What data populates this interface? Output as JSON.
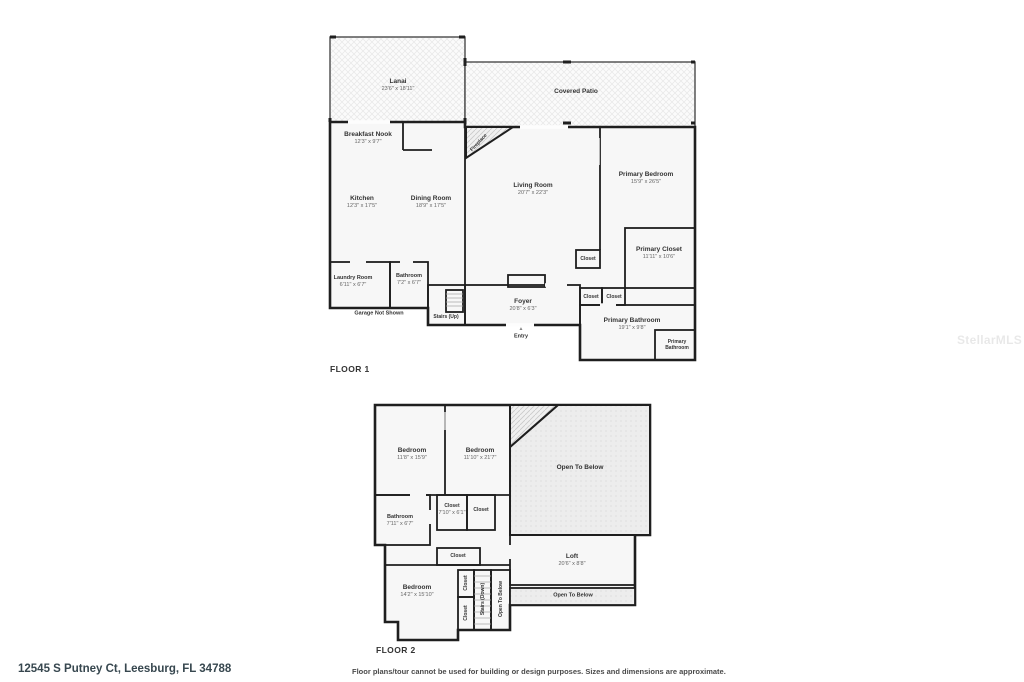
{
  "floor1": {
    "title": "FLOOR 1",
    "rooms": {
      "lanai": {
        "name": "Lanai",
        "dims": "23'6\" x 18'11\""
      },
      "covered_patio": {
        "name": "Covered Patio"
      },
      "breakfast_nook": {
        "name": "Breakfast Nook",
        "dims": "12'3\" x 9'7\""
      },
      "fireplace": {
        "name": "Fireplace"
      },
      "kitchen": {
        "name": "Kitchen",
        "dims": "12'3\" x 17'5\""
      },
      "dining_room": {
        "name": "Dining Room",
        "dims": "18'9\" x 17'5\""
      },
      "living_room": {
        "name": "Living Room",
        "dims": "20'7\" x 22'3\""
      },
      "primary_bedroom": {
        "name": "Primary Bedroom",
        "dims": "15'9\" x 26'5\""
      },
      "primary_closet": {
        "name": "Primary Closet",
        "dims": "11'11\" x 10'6\""
      },
      "laundry_room": {
        "name": "Laundry Room",
        "dims": "6'11\" x 6'7\""
      },
      "bathroom": {
        "name": "Bathroom",
        "dims": "7'2\" x 6'7\""
      },
      "foyer": {
        "name": "Foyer",
        "dims": "20'8\" x 6'3\""
      },
      "primary_bathroom": {
        "name": "Primary Bathroom",
        "dims": "19'1\" x 9'8\""
      },
      "primary_bathroom_small": {
        "name": "Primary Bathroom"
      },
      "closet": {
        "name": "Closet"
      }
    },
    "notes": {
      "stairs_up": "Stairs (Up)",
      "garage": "Garage Not Shown",
      "entry": "Entry",
      "entry_marker": "▲"
    }
  },
  "floor2": {
    "title": "FLOOR 2",
    "rooms": {
      "bedroom_left": {
        "name": "Bedroom",
        "dims": "11'8\" x 15'9\""
      },
      "bedroom_mid": {
        "name": "Bedroom",
        "dims": "11'10\" x 21'7\""
      },
      "open_to_below": {
        "name": "Open To Below"
      },
      "bathroom": {
        "name": "Bathroom",
        "dims": "7'11\" x 6'7\""
      },
      "closet_with_dims": {
        "name": "Closet",
        "dims": "7'10\" x 6'1\""
      },
      "closet": {
        "name": "Closet"
      },
      "loft": {
        "name": "Loft",
        "dims": "20'6\" x 8'8\""
      },
      "bedroom_bottom": {
        "name": "Bedroom",
        "dims": "14'2\" x 15'10\""
      },
      "stairs_down": {
        "name": "Stairs (Down)"
      }
    }
  },
  "footer": {
    "address": "12545 S Putney Ct, Leesburg, FL 34788",
    "disclaimer": "Floor plans/tour cannot be used for building or design purposes. Sizes and dimensions are approximate."
  },
  "watermark": "StellarMLS",
  "colors": {
    "wall": "#1f1f1f",
    "room_fill": "#f7f7f7",
    "outdoor_fill": "#fbfbfb",
    "open_below_fill": "#ececec"
  }
}
